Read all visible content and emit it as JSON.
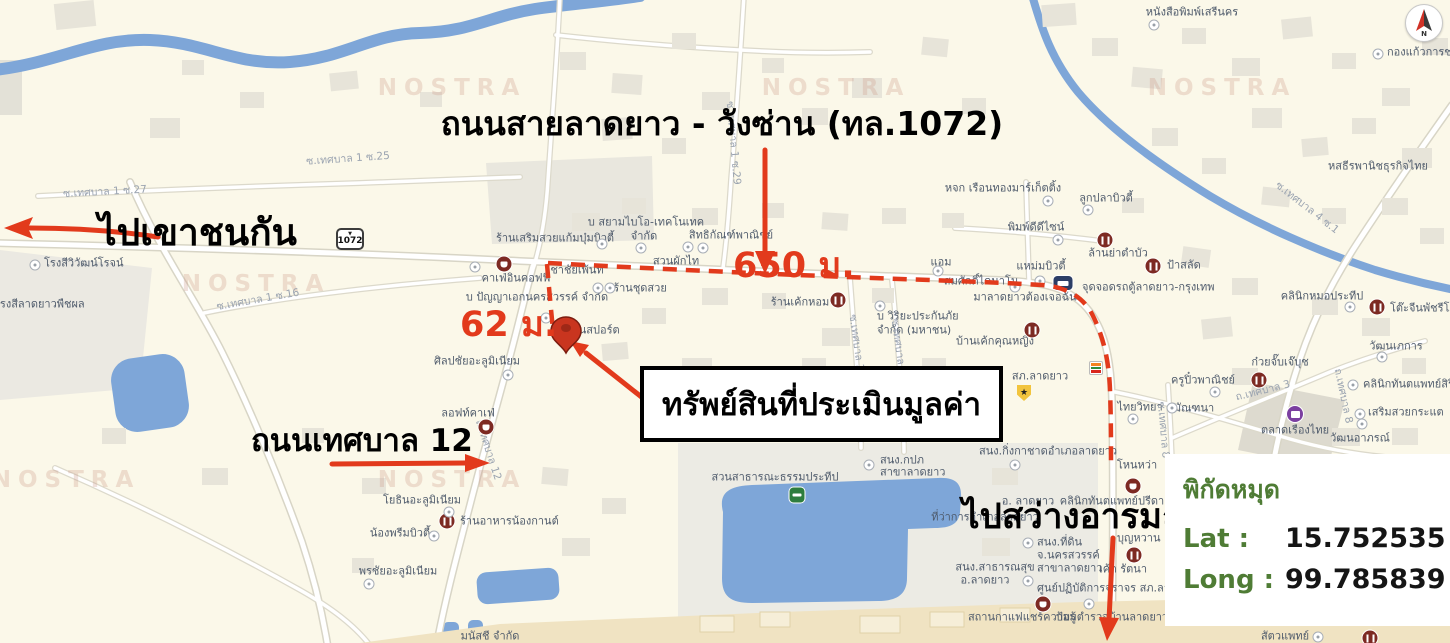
{
  "colors": {
    "map-bg": "#fbf8e9",
    "water": "#7ea6d8",
    "annotation-red": "#e23a1c",
    "pin-red": "#c9351f",
    "maroon": "#7d2a23",
    "coord-green": "#4f7c35",
    "poi-text": "#4e5a6b",
    "road-text": "#9aa3b0"
  },
  "annotations": {
    "road_title": "ถนนสายลาดยาว - วังซ่าน (ทล.1072)",
    "to_west": "ไปเขาชนกัน",
    "to_south": "ไปสว่างอารมณ์",
    "road_12": "ถนนเทศบาล 12",
    "property": "ทรัพย์สินที่ประเมินมูลค่า",
    "dist_main": "650 ม.",
    "dist_soi": "62 ม."
  },
  "coordinates_panel": {
    "title": "พิกัดหมุด",
    "lat_label": "Lat :",
    "lat_value": "15.752535",
    "long_label": "Long :",
    "long_value": "99.785839"
  },
  "compass": {
    "letter": "N"
  },
  "highway_shield": {
    "marker": "▼",
    "number": "1072"
  },
  "watermark_text": "NOSTRA",
  "watermarks": [
    {
      "x": 452,
      "y": 88
    },
    {
      "x": 836,
      "y": 88
    },
    {
      "x": 1222,
      "y": 88
    },
    {
      "x": 256,
      "y": 284
    },
    {
      "x": 66,
      "y": 480
    },
    {
      "x": 452,
      "y": 480
    }
  ],
  "map_labels": [
    {
      "t": "หนังสือพิมพ์เสรีนคร",
      "x": 1192,
      "y": 12
    },
    {
      "t": "กองแก้วการช่าง",
      "x": 1387,
      "y": 52,
      "a": "l"
    },
    {
      "t": "หสธีรพานิชธุรกิจไทย",
      "x": 1378,
      "y": 166
    },
    {
      "t": "หจก เรือนทองมาร์เก็ตติ้ง",
      "x": 1003,
      "y": 188
    },
    {
      "t": "ลูกปลาบิวตี้",
      "x": 1106,
      "y": 198
    },
    {
      "t": "พิมพ์ดีดีไซน์",
      "x": 1036,
      "y": 227
    },
    {
      "t": "ล้านย่าตำบัว",
      "x": 1118,
      "y": 253
    },
    {
      "t": "ป้าสลัด",
      "x": 1167,
      "y": 265,
      "a": "l"
    },
    {
      "t": "แอม",
      "x": 941,
      "y": 262
    },
    {
      "t": "สมศักดิ์ไดนาโม",
      "x": 981,
      "y": 281
    },
    {
      "t": "มาลาดยาวต้องเจอฉัน",
      "x": 1025,
      "y": 297
    },
    {
      "t": "แหม่มบิวตี้",
      "x": 1041,
      "y": 266
    },
    {
      "t": "จุดจอดรถตู้ลาดยาว-กรุงเทพ",
      "x": 1082,
      "y": 287,
      "a": "l"
    },
    {
      "t": "สิทธิกัณฑ์พาณิชย์",
      "x": 731,
      "y": 235
    },
    {
      "t": "บ สยามไบโอ-เทคโนเทค",
      "x": 646,
      "y": 222
    },
    {
      "t": "จำกัด",
      "x": 644,
      "y": 236
    },
    {
      "t": "สวนผักไท",
      "x": 676,
      "y": 261
    },
    {
      "t": "ร้านเสริมสวยแก้มบุ๋มบิวตี้",
      "x": 555,
      "y": 238
    },
    {
      "t": "คาเฟ่อินคอฟฟี่",
      "x": 516,
      "y": 278
    },
    {
      "t": "ชาชัยเพ้นท์",
      "x": 577,
      "y": 270
    },
    {
      "t": "บ ปัญญาเอกนครสวรรค์ จำกัด",
      "x": 537,
      "y": 297
    },
    {
      "t": "ร้านชุดสวย",
      "x": 640,
      "y": 288
    },
    {
      "t": "เอ็นสปอร์ต",
      "x": 594,
      "y": 330
    },
    {
      "t": "ร้านเค้กหอม",
      "x": 800,
      "y": 302
    },
    {
      "t": "บ วิริยะประกันภัย",
      "x": 877,
      "y": 316,
      "a": "l"
    },
    {
      "t": "จำกัด (มหาชน)",
      "x": 877,
      "y": 330,
      "a": "l"
    },
    {
      "t": "บ้านเค้กคุณหญิง",
      "x": 995,
      "y": 341
    },
    {
      "t": "สภ.ลาดยาว",
      "x": 1040,
      "y": 376
    },
    {
      "t": "ครูปิ๋วพาณิชย์",
      "x": 1203,
      "y": 380
    },
    {
      "t": "ไทยวิทยา",
      "x": 1140,
      "y": 407
    },
    {
      "t": "มัณฑนา",
      "x": 1194,
      "y": 408
    },
    {
      "t": "คลินิกหมอประทีป",
      "x": 1322,
      "y": 296
    },
    {
      "t": "โต๊ะจีนพัชรีโภชนา",
      "x": 1390,
      "y": 308,
      "a": "l"
    },
    {
      "t": "วัฒนเภการ",
      "x": 1396,
      "y": 346
    },
    {
      "t": "ก๋วยจั๊บเจ๊บุช",
      "x": 1280,
      "y": 362
    },
    {
      "t": "คลินิกทันตแพทย์สิริลักษณ์",
      "x": 1363,
      "y": 384,
      "a": "l"
    },
    {
      "t": "เสริมสวยกระแต",
      "x": 1368,
      "y": 412,
      "a": "l"
    },
    {
      "t": "วัฒนอาภรณ์",
      "x": 1360,
      "y": 438
    },
    {
      "t": "ตลาดเรืองไทย",
      "x": 1295,
      "y": 430
    },
    {
      "t": "สนง.กิ่งกาชาดอำเภอลาดยาว",
      "x": 1048,
      "y": 451
    },
    {
      "t": "โหนหว่า",
      "x": 1137,
      "y": 465
    },
    {
      "t": "สนง.กปภ",
      "x": 880,
      "y": 460,
      "a": "l"
    },
    {
      "t": "สาขาลาดยาว",
      "x": 880,
      "y": 472,
      "a": "l"
    },
    {
      "t": "สวนสาธารณะธรรมประทีป",
      "x": 775,
      "y": 477
    },
    {
      "t": "อ. ลาดยาว",
      "x": 1028,
      "y": 501
    },
    {
      "t": "ที่ว่าการอำเภอลาดยาว",
      "x": 985,
      "y": 517
    },
    {
      "t": "คลินิกทันตแพทย์ปรีดา",
      "x": 1112,
      "y": 501
    },
    {
      "t": "สนง.ที่ดิน",
      "x": 1037,
      "y": 542,
      "a": "l"
    },
    {
      "t": "จ.นครสวรรค์",
      "x": 1037,
      "y": 555,
      "a": "l"
    },
    {
      "t": "สาขาลาดยาว",
      "x": 1037,
      "y": 568,
      "a": "l"
    },
    {
      "t": "บุญหวาน",
      "x": 1117,
      "y": 538,
      "a": "l"
    },
    {
      "t": "สนง.สาธารณสุข",
      "x": 995,
      "y": 567
    },
    {
      "t": "อ.ลาดยาว",
      "x": 985,
      "y": 580
    },
    {
      "t": "เค้ก รัตนา",
      "x": 1123,
      "y": 569
    },
    {
      "t": "ศูนย์ปฏิบัติการจราจร สภ.ลาดยาว",
      "x": 1037,
      "y": 588,
      "a": "l"
    },
    {
      "t": "สถานกาแฟแชร์ความรู้",
      "x": 1022,
      "y": 617
    },
    {
      "t": "ป้อมตำรวจบ้านลาดยาว",
      "x": 1112,
      "y": 617
    },
    {
      "t": "สัตวแพทย์",
      "x": 1285,
      "y": 636
    },
    {
      "t": "โรงสีวิวัฒน์โรจน์",
      "x": 44,
      "y": 263,
      "a": "l"
    },
    {
      "t": "โรงสีลาดยาวพืชผล",
      "x": -6,
      "y": 304,
      "a": "l"
    },
    {
      "t": "ศิลปชัยอะลูมิเนียม",
      "x": 477,
      "y": 361
    },
    {
      "t": "ลอฟท์คาเฟ่",
      "x": 468,
      "y": 413
    },
    {
      "t": "โยธินอะลูมิเนียม",
      "x": 422,
      "y": 500
    },
    {
      "t": "ร้านอาหารน้องกานต์",
      "x": 460,
      "y": 521,
      "a": "l"
    },
    {
      "t": "น้องพรีมบิวตี้",
      "x": 400,
      "y": 533
    },
    {
      "t": "พรชัยอะลูมิเนียม",
      "x": 398,
      "y": 571
    },
    {
      "t": "มนัสชี จำกัด",
      "x": 490,
      "y": 636
    },
    {
      "t": "ซ.เทศบาล 1 ซ.27",
      "x": 105,
      "y": 192,
      "r": -3,
      "k": "road"
    },
    {
      "t": "ซ.เทศบาล 1 ซ.25",
      "x": 348,
      "y": 159,
      "r": -4,
      "k": "road"
    },
    {
      "t": "ซ.เทศบาล 1 ซ.16",
      "x": 258,
      "y": 300,
      "r": -10,
      "k": "road"
    },
    {
      "t": "ซ.เทศบาล 1 ซ.29",
      "x": 733,
      "y": 143,
      "r": 85,
      "k": "road"
    },
    {
      "t": "ถ.เทศบาล 12",
      "x": 488,
      "y": 450,
      "r": 72,
      "k": "road"
    },
    {
      "t": "ซ.เทศบาล 1 ซ.10",
      "x": 858,
      "y": 356,
      "r": 82,
      "k": "road"
    },
    {
      "t": "ซ.เทศบาล 1 ซ.20",
      "x": 900,
      "y": 360,
      "r": 82,
      "k": "road"
    },
    {
      "t": "ซ.เทศบาล 4 ซ.1",
      "x": 1307,
      "y": 208,
      "r": 38,
      "k": "road"
    },
    {
      "t": "ถ.เทศบาล 8",
      "x": 1343,
      "y": 396,
      "r": 78,
      "k": "road"
    },
    {
      "t": "ถ.เทศบาล 3",
      "x": 1263,
      "y": 391,
      "r": -14,
      "k": "road"
    },
    {
      "t": "ซ.เทศบาล 8",
      "x": 1163,
      "y": 430,
      "r": 85,
      "k": "road"
    }
  ],
  "poi_icons": [
    {
      "k": "restaurant",
      "x": 1105,
      "y": 240
    },
    {
      "k": "restaurant",
      "x": 1153,
      "y": 266
    },
    {
      "k": "restaurant",
      "x": 838,
      "y": 300
    },
    {
      "k": "restaurant",
      "x": 1134,
      "y": 555
    },
    {
      "k": "restaurant",
      "x": 1032,
      "y": 330
    },
    {
      "k": "restaurant",
      "x": 1377,
      "y": 307
    },
    {
      "k": "restaurant",
      "x": 1259,
      "y": 380
    },
    {
      "k": "restaurant",
      "x": 447,
      "y": 521
    },
    {
      "k": "restaurant",
      "x": 1370,
      "y": 638
    },
    {
      "k": "coffee",
      "x": 504,
      "y": 264
    },
    {
      "k": "coffee",
      "x": 486,
      "y": 427
    },
    {
      "k": "coffee",
      "x": 1043,
      "y": 604
    },
    {
      "k": "coffee",
      "x": 1133,
      "y": 486
    },
    {
      "k": "bus",
      "x": 1063,
      "y": 283
    },
    {
      "k": "shop",
      "x": 1295,
      "y": 414
    },
    {
      "k": "park",
      "x": 797,
      "y": 495
    },
    {
      "k": "seven",
      "x": 1096,
      "y": 368
    },
    {
      "k": "police",
      "x": 1024,
      "y": 393
    },
    {
      "k": "dot",
      "x": 1154,
      "y": 25
    },
    {
      "k": "dot",
      "x": 1378,
      "y": 54
    },
    {
      "k": "dot",
      "x": 1048,
      "y": 201
    },
    {
      "k": "dot",
      "x": 1088,
      "y": 210
    },
    {
      "k": "dot",
      "x": 1058,
      "y": 240
    },
    {
      "k": "dot",
      "x": 938,
      "y": 271
    },
    {
      "k": "dot",
      "x": 1015,
      "y": 287
    },
    {
      "k": "dot",
      "x": 1040,
      "y": 281
    },
    {
      "k": "dot",
      "x": 602,
      "y": 244
    },
    {
      "k": "dot",
      "x": 641,
      "y": 248
    },
    {
      "k": "dot",
      "x": 688,
      "y": 247
    },
    {
      "k": "dot",
      "x": 703,
      "y": 248
    },
    {
      "k": "dot",
      "x": 475,
      "y": 267
    },
    {
      "k": "dot",
      "x": 546,
      "y": 318
    },
    {
      "k": "dot",
      "x": 598,
      "y": 288
    },
    {
      "k": "dot",
      "x": 610,
      "y": 288
    },
    {
      "k": "dot",
      "x": 880,
      "y": 306
    },
    {
      "k": "dot",
      "x": 35,
      "y": 265
    },
    {
      "k": "dot",
      "x": 449,
      "y": 512
    },
    {
      "k": "dot",
      "x": 434,
      "y": 536
    },
    {
      "k": "dot",
      "x": 369,
      "y": 584
    },
    {
      "k": "dot",
      "x": 508,
      "y": 375
    },
    {
      "k": "dot",
      "x": 1215,
      "y": 392
    },
    {
      "k": "dot",
      "x": 1133,
      "y": 419
    },
    {
      "k": "dot",
      "x": 1172,
      "y": 408
    },
    {
      "k": "dot",
      "x": 1015,
      "y": 465
    },
    {
      "k": "dot",
      "x": 869,
      "y": 465
    },
    {
      "k": "dot",
      "x": 1028,
      "y": 543
    },
    {
      "k": "dot",
      "x": 1028,
      "y": 581
    },
    {
      "k": "dot",
      "x": 1089,
      "y": 604
    },
    {
      "k": "dot",
      "x": 1362,
      "y": 424
    },
    {
      "k": "dot",
      "x": 1360,
      "y": 414
    },
    {
      "k": "dot",
      "x": 1353,
      "y": 385
    },
    {
      "k": "dot",
      "x": 1382,
      "y": 357
    },
    {
      "k": "dot",
      "x": 1350,
      "y": 307
    },
    {
      "k": "dot",
      "x": 1318,
      "y": 637
    }
  ]
}
